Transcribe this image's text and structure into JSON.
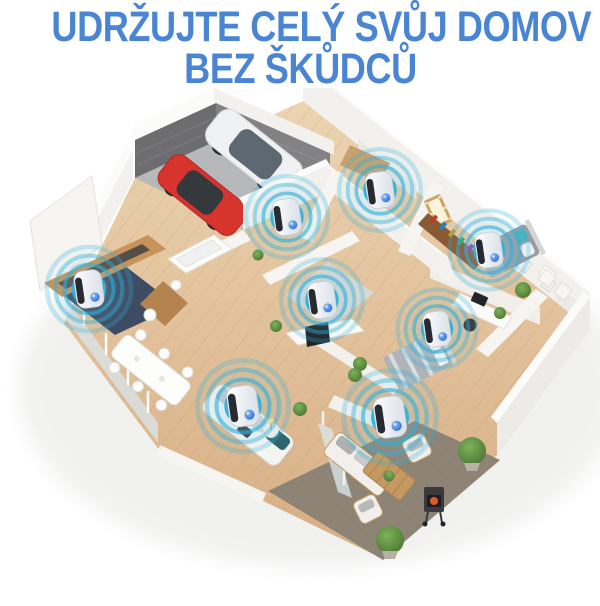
{
  "headline": {
    "line1": "UDRŽUJTE CELÝ SVŮJ DOMOV",
    "line2": "BEZ ŠKŮDCŮ"
  },
  "colors": {
    "headline_blue": "#4a85d4",
    "ring_cyan": "#2fb0da",
    "led_blue": "#2160d8",
    "wood_floor_light": "#ecd4b2",
    "wood_floor_dark": "#d7ae84",
    "wall_white": "#f3f2ef",
    "garage_wall_dark": "#6d6d6f",
    "garage_floor_grey": "#b7b8ba",
    "patio_rug_taupe": "#8e8577",
    "kitchen_rug_navy": "#3d4c63"
  },
  "devices": [
    {
      "room": "entry-hall",
      "x": 287,
      "y": 224,
      "scale": 0.95
    },
    {
      "room": "dressing-room",
      "x": 380,
      "y": 197,
      "scale": 0.95
    },
    {
      "room": "master-bedroom",
      "x": 489,
      "y": 257,
      "scale": 0.92
    },
    {
      "room": "kitchen",
      "x": 89,
      "y": 296,
      "scale": 0.98
    },
    {
      "room": "family-room",
      "x": 322,
      "y": 307,
      "scale": 0.95
    },
    {
      "room": "study",
      "x": 437,
      "y": 336,
      "scale": 0.92
    },
    {
      "room": "living-room",
      "x": 243,
      "y": 413,
      "scale": 1.06
    },
    {
      "room": "patio",
      "x": 390,
      "y": 424,
      "scale": 1.08
    }
  ]
}
